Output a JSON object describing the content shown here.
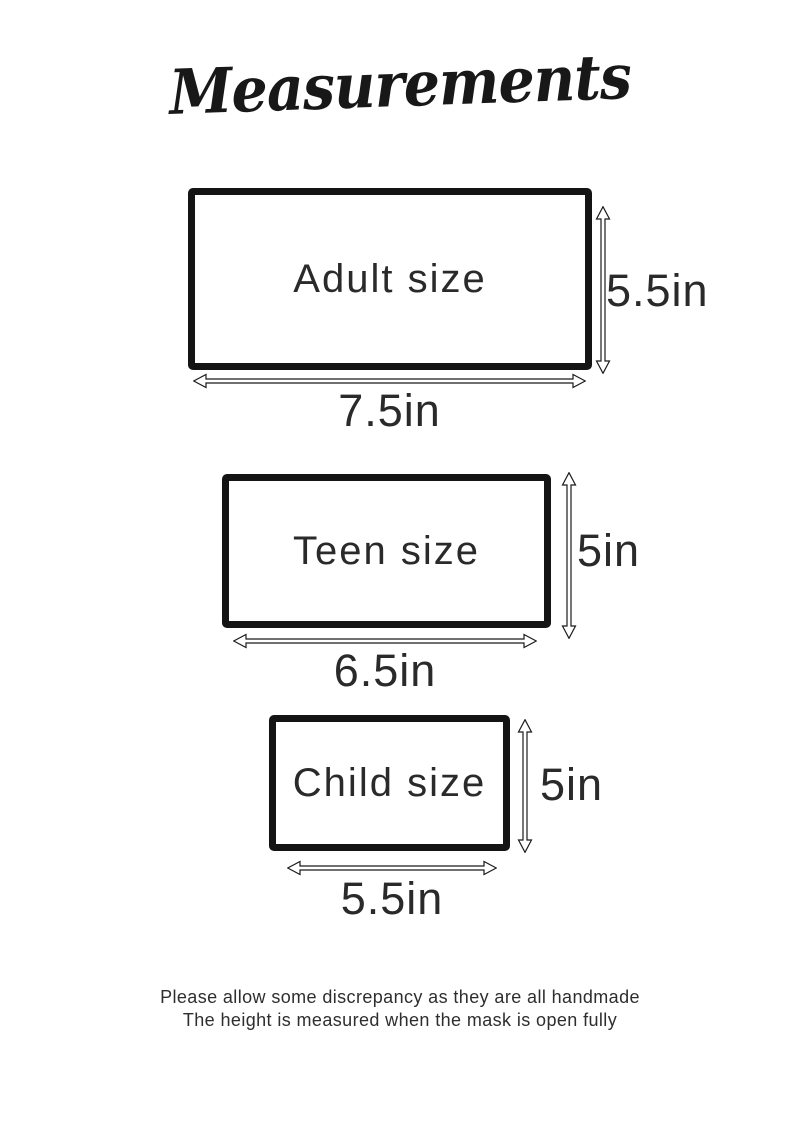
{
  "title": "Measurements",
  "colors": {
    "ink": "#1b1b1b",
    "background": "#ffffff"
  },
  "sizes": [
    {
      "name": "Adult size",
      "width": "7.5in",
      "height": "5.5in"
    },
    {
      "name": "Teen size",
      "width": "6.5in",
      "height": "5in"
    },
    {
      "name": "Child size",
      "width": "5.5in",
      "height": "5in"
    }
  ],
  "footer": {
    "line1": "Please allow some discrepancy as they are all handmade",
    "line2": "The height is measured when the mask is open fully"
  }
}
